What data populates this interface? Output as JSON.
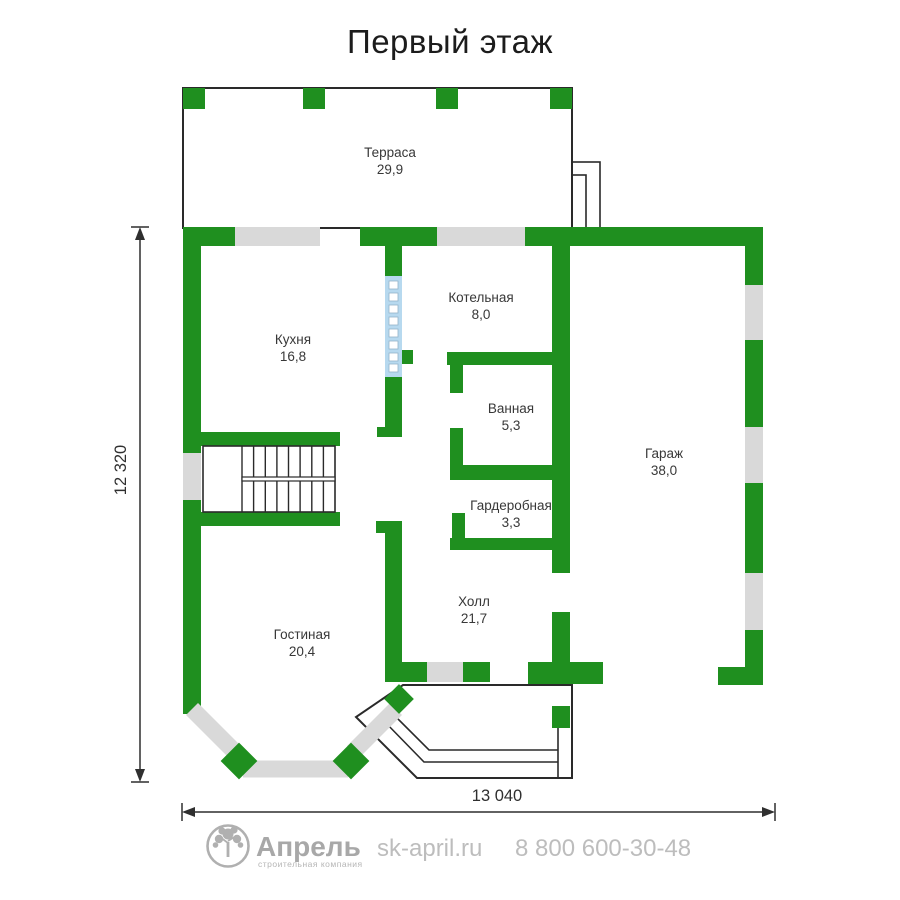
{
  "title": "Первый этаж",
  "rooms": {
    "terrace": {
      "name": "Терраса",
      "area": "29,9"
    },
    "kitchen": {
      "name": "Кухня",
      "area": "16,8"
    },
    "boiler": {
      "name": "Котельная",
      "area": "8,0"
    },
    "bathroom": {
      "name": "Ванная",
      "area": "5,3"
    },
    "wardrobe": {
      "name": "Гардеробная",
      "area": "3,3"
    },
    "garage": {
      "name": "Гараж",
      "area": "38,0"
    },
    "hall": {
      "name": "Холл",
      "area": "21,7"
    },
    "living": {
      "name": "Гостиная",
      "area": "20,4"
    }
  },
  "dimensions": {
    "vertical": "12 320",
    "horizontal": "13 040"
  },
  "footer": {
    "brand": "Апрель",
    "tagline": "строительная компания",
    "website": "sk-april.ru",
    "phone": "8 800 600-30-48"
  },
  "colors": {
    "wall": "#1f8f1f",
    "window": "#d9d9d9",
    "glass_block": "#b7d9ef",
    "outline": "#2a2a2a",
    "label": "#383838"
  }
}
